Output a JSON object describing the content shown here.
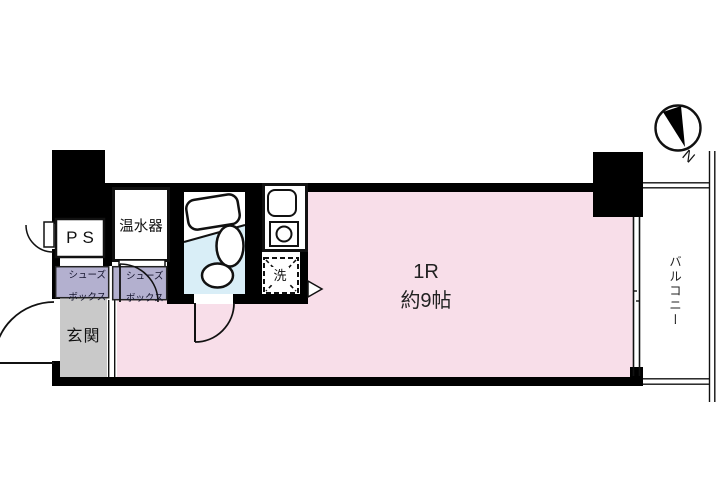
{
  "plan": {
    "type_label": "1R",
    "size_label": "約9帖",
    "labels": {
      "ps": "PS",
      "water_heater": "温水器",
      "shoe_box_1": [
        "シューズ",
        "ボックス"
      ],
      "shoe_box_2": [
        "シューズ",
        "ボックス"
      ],
      "entrance": "玄関",
      "washer": "洗",
      "balcony": "バルコニー",
      "compass_north": "N"
    },
    "colors": {
      "room": "#f8dee9",
      "bathroom": "#d9eef7",
      "shoe_box": "#b3b0cf",
      "entrance_floor": "#c9c9c9",
      "wall": "#000000"
    }
  }
}
